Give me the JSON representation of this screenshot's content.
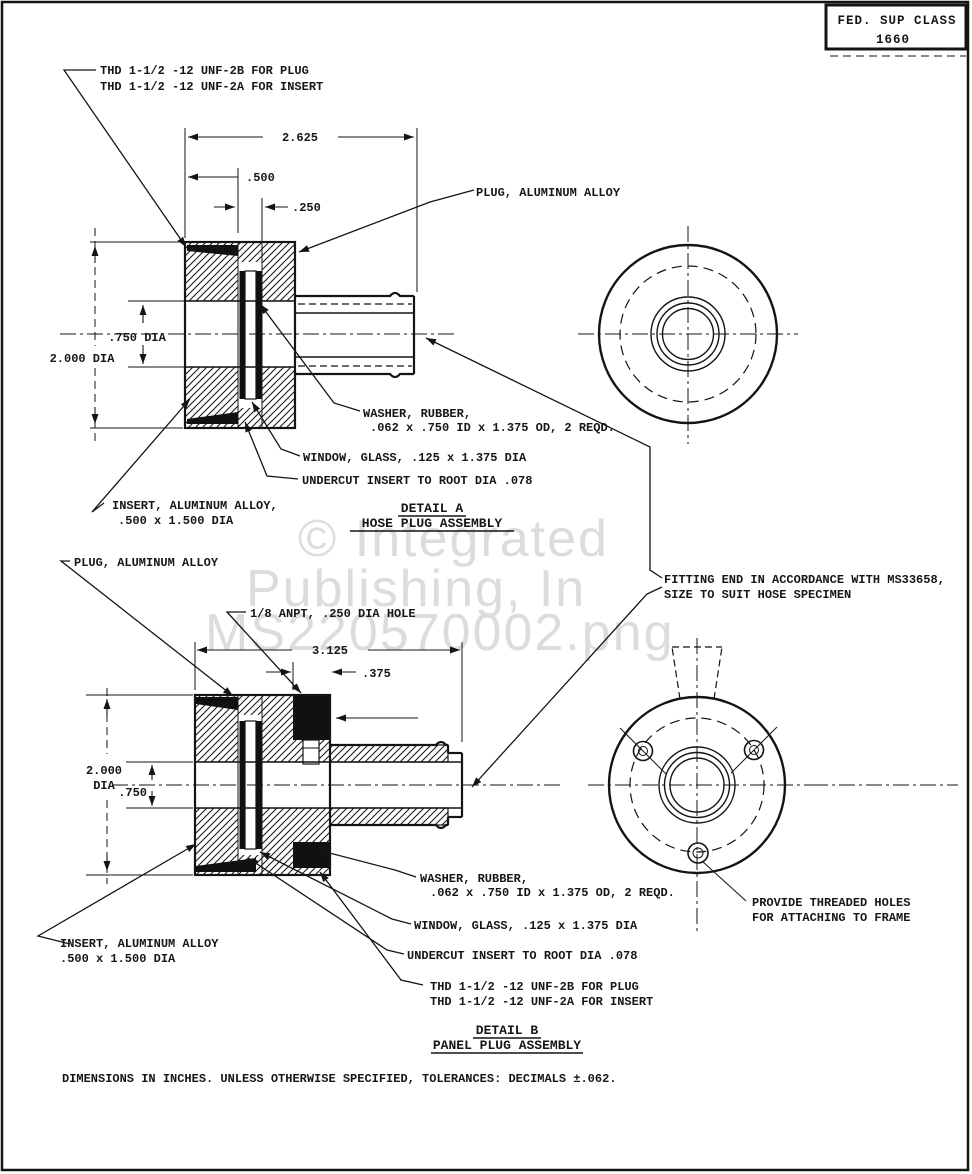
{
  "page": {
    "fed_sup_class_label": "FED. SUP CLASS",
    "fed_sup_class_value": "1660",
    "footer_note": "DIMENSIONS IN INCHES. UNLESS OTHERWISE SPECIFIED, TOLERANCES: DECIMALS ±.062."
  },
  "watermark": {
    "line1": "© Integrated",
    "line2": "Publishing, In",
    "line3": "MS220570002.png"
  },
  "detail_a": {
    "title": "DETAIL A",
    "subtitle": "HOSE PLUG ASSEMBLY",
    "thd_line1": "THD 1-1/2 -12 UNF-2B FOR PLUG",
    "thd_line2": "THD 1-1/2 -12 UNF-2A FOR INSERT",
    "plug_label": "PLUG, ALUMINUM ALLOY",
    "washer_line1": "WASHER, RUBBER,",
    "washer_line2": ".062 x .750 ID x 1.375 OD, 2 REQD.",
    "window_label": "WINDOW, GLASS, .125 x 1.375 DIA",
    "undercut_label": "UNDERCUT INSERT TO ROOT DIA .078",
    "insert_line1": "INSERT, ALUMINUM ALLOY,",
    "insert_line2": ".500 x 1.500 DIA",
    "fitting_line1": "FITTING END IN ACCORDANCE WITH MS33658,",
    "fitting_line2": "SIZE TO SUIT HOSE SPECIMEN",
    "dim_overall": "2.625",
    "dim_500": ".500",
    "dim_250": ".250",
    "dim_bore": ".750 DIA",
    "dim_od": "2.000 DIA"
  },
  "detail_b": {
    "title": "DETAIL B",
    "subtitle": "PANEL PLUG ASSEMBLY",
    "plug_label": "PLUG, ALUMINUM ALLOY",
    "anpt_label": "1/8 ANPT, .250 DIA HOLE",
    "washer_line1": "WASHER, RUBBER,",
    "washer_line2": ".062 x .750 ID x 1.375 OD, 2 REQD.",
    "window_label": "WINDOW, GLASS, .125 x 1.375 DIA",
    "undercut_label": "UNDERCUT INSERT TO ROOT DIA .078",
    "thd_line1": "THD 1-1/2 -12 UNF-2B FOR PLUG",
    "thd_line2": "THD 1-1/2 -12 UNF-2A FOR INSERT",
    "insert_line1": "INSERT, ALUMINUM ALLOY",
    "insert_line2": ".500 x 1.500 DIA",
    "holes_line1": "PROVIDE THREADED HOLES",
    "holes_line2": "FOR ATTACHING TO FRAME",
    "dim_overall": "3.125",
    "dim_375": ".375",
    "dim_od_line1": "2.000",
    "dim_od_line2": "DIA",
    "dim_bore": ".750"
  }
}
